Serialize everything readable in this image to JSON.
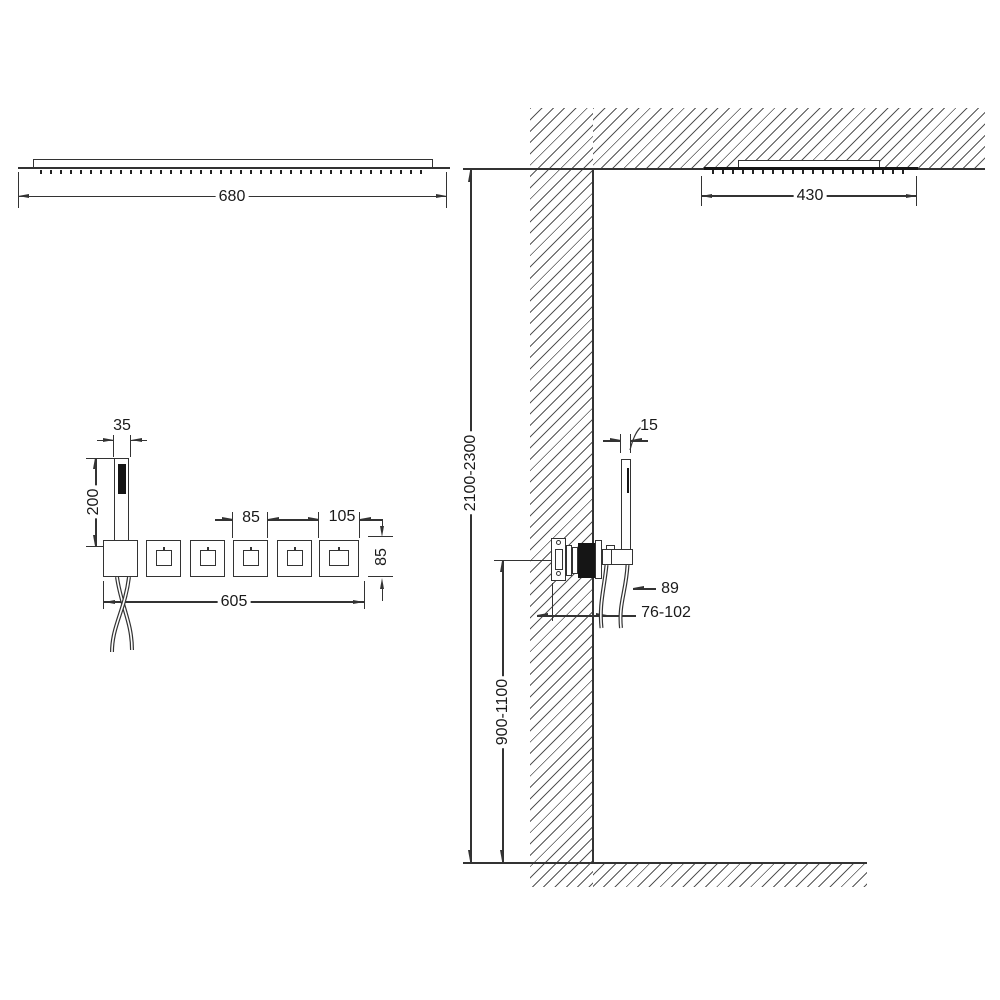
{
  "diagram": {
    "type": "shower-system-installation-drawing",
    "front_view": {
      "ceiling_shower_width": "680",
      "hand_shower_width": "35",
      "hand_shower_height": "200",
      "plate_width": "85",
      "end_plate_width": "105",
      "plate_height": "85",
      "valve_row_width": "605"
    },
    "side_view": {
      "ceiling_shower_depth": "430",
      "hand_shower_depth": "15",
      "valve_projection": "89",
      "embed_depth_range": "76-102",
      "ceiling_height_range": "2100-2300",
      "valve_height_range": "900-1100"
    },
    "colors": {
      "line": "#333333",
      "hatch": "#555555",
      "dark_fill": "#151515",
      "background": "#ffffff"
    }
  }
}
